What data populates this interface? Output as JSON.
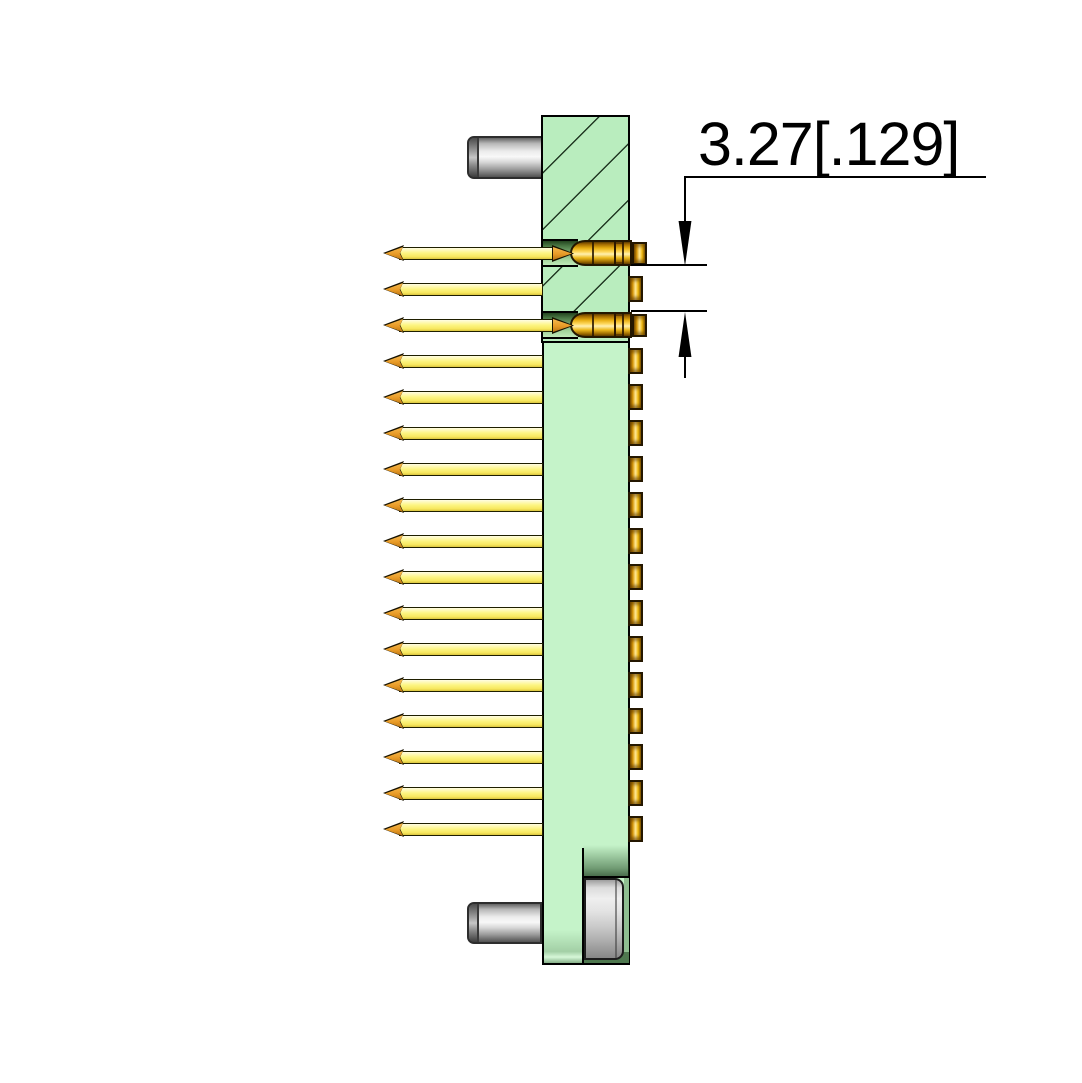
{
  "drawing": {
    "kind": "connector-side-section-view",
    "dimension": {
      "label": "3.27[.129]"
    },
    "connector": {
      "pin_count": 17,
      "sectioned_row_indices": [
        0,
        2
      ],
      "pin_rows_with_contact_barrel": 2,
      "mounting_standoffs": 2,
      "screw_recesses": 1
    },
    "theme": {
      "flange_green": "#b9edbe",
      "body_green": "#c5f3c9",
      "pin_yellow": "#fdf584",
      "pin_tip_orange": "#e89a26",
      "contact_gold": "#ffd95e",
      "metal_gray": "#d8d8d8",
      "line_black": "#000000",
      "background": "#ffffff"
    }
  }
}
